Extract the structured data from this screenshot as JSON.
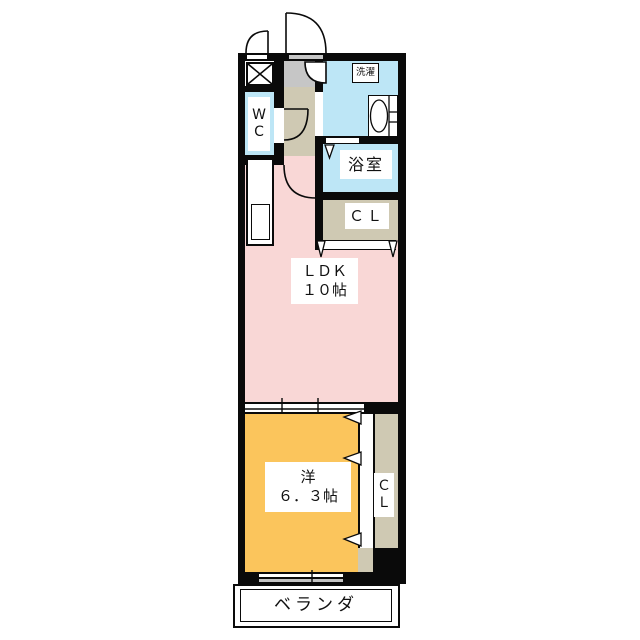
{
  "floorplan": {
    "labels": {
      "wc_line1": "W",
      "wc_line2": "C",
      "laundry": "洗濯",
      "bathroom": "浴室",
      "closet_upper": "ＣＬ",
      "ldk_line1": "ＬＤＫ",
      "ldk_line2": "１０帖",
      "bedroom_line1": "洋",
      "bedroom_line2": "６．３帖",
      "closet_bedroom_line1": "Ｃ",
      "closet_bedroom_line2": "Ｌ",
      "veranda": "ベランダ"
    },
    "colors": {
      "ldk_pink": "#F9D7D6",
      "bedroom_orange": "#FBC55C",
      "wet_area_blue": "#BDE6F6",
      "closet_beige": "#CFC9B3",
      "entry_gray": "#C6C6C6",
      "wall_black": "#0A0A0A",
      "window_gray": "#C4C4C4"
    }
  }
}
